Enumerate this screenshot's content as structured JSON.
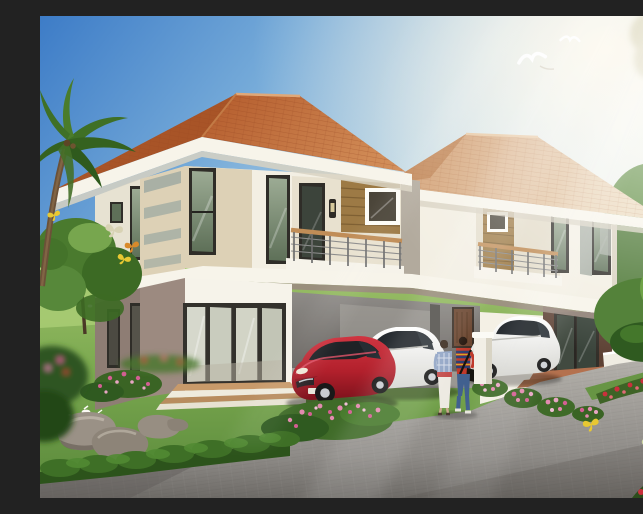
{
  "scene": {
    "title": "Twin two-storey house exterior rendering",
    "description": "Architectural rendering of a modern two-storey duplex house with orange terracotta hip roofs, deep white eaves, cream walls with timber and grey accent panels, two balconies with timber-and-steel railings, a carport sheltering a red hatchback and a white sedan, a second white sedan parked by the right entrance, a couple walking up the grey paver driveway, a child sitting on the lawn with white doves, boulders, flower beds, trimmed hedges, a palm tree and leafy trees, butterflies, and two gulls in a blue sky streaked with sunlight.",
    "sky": {
      "kind": "clear blue fading to warm sunlit haze on the right",
      "birds": "two white gulls",
      "light_rays": "diagonal sun rays from upper right"
    },
    "house": {
      "storeys": 2,
      "units": 2,
      "roof": {
        "style": "hip",
        "material": "terracotta tile",
        "color": "#c06a3a"
      },
      "features": [
        "deep white fascia and eaves",
        "balcony with timber top-rail and steel bars on each unit",
        "timber plank accent walls beside balconies",
        "dark-framed full-height windows",
        "ground-floor four-panel sliding glass doors with tan steps",
        "central double carport with interior timber door",
        "dark timber entry doors on right unit with terracotta steps",
        "white gate post and low white garden wall",
        "wall lamp beside balcony door"
      ]
    },
    "vehicles": [
      {
        "type": "hatchback",
        "color_name": "red",
        "position": "carport, left bay"
      },
      {
        "type": "sedan",
        "color_name": "white",
        "position": "carport, right bay"
      },
      {
        "type": "sedan",
        "color_name": "white",
        "position": "driveway by right entrance"
      }
    ],
    "people": [
      {
        "who": "woman walking",
        "outfit": "blue plaid shirt, red waist sash, long white skirt"
      },
      {
        "who": "man walking",
        "outfit": "red-navy-yellow striped shirt, blue jeans, black shoulder bag"
      },
      {
        "who": "child sitting on lawn",
        "outfit": "yellow shirt"
      }
    ],
    "wildlife": [
      "two white gulls in the sky",
      "white doves beside the child",
      "hens grazing on the far lawn",
      "yellow and orange butterflies"
    ],
    "landscape": [
      "palm tree at left edge",
      "leafy green tree on left lawn",
      "soft green trees and clipped shrubs on the right",
      "pink flower clusters along the driveway",
      "red flower beds at lower right",
      "grey boulders on the lawn",
      "trimmed dark hedge along the road",
      "grey paver driveway and road"
    ]
  },
  "palette": {
    "sky_deep": "#3d7cc7",
    "sky_pale": "#dcebef",
    "roof_main": "#c06a3a",
    "roof_shade": "#a85427",
    "roof_far": "#d9a77b",
    "fascia_white": "#f7f4ea",
    "wall_cream": "#f3efe3",
    "wall_beige": "#ddd1b6",
    "wall_grey_accent": "#aab0a6",
    "wall_taupe": "#8e7d74",
    "entry_brown": "#5d4134",
    "timber_panel": "#9d7a45",
    "frame_dark": "#2f2d28",
    "lawn_green": "#6f9c45",
    "hedge_green": "#2f5a20",
    "driveway_grey": "#9b9893",
    "car_red": "#b2202c",
    "car_white": "#f4f4f0",
    "flower_pink": "#e38bb0",
    "flower_red": "#c9303c",
    "butterfly_yellow": "#e8c832"
  }
}
